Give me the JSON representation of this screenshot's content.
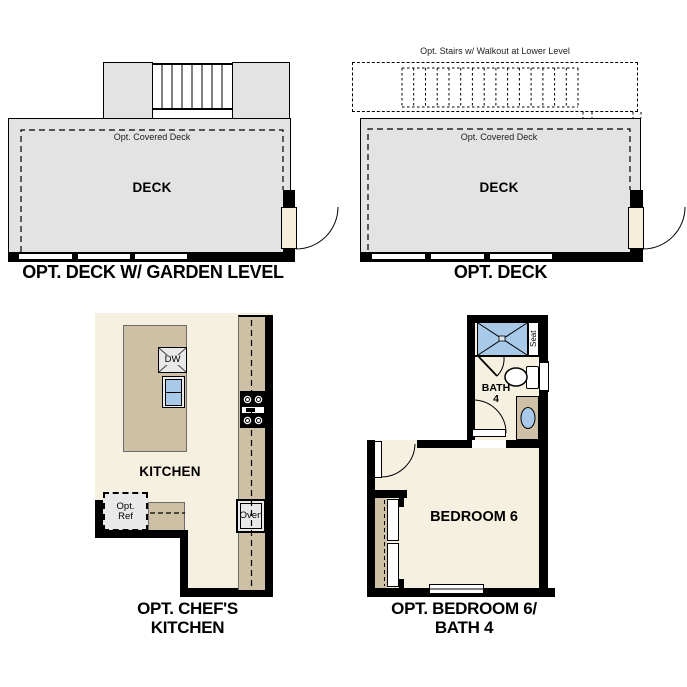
{
  "colors": {
    "wall": "#000000",
    "deck": "#e3e3e3",
    "floor": "#f6f0e0",
    "cabinet": "#cec0a5",
    "fixture": "#e9e9e9",
    "water": "#a9c9e9",
    "door": "#f4eedb"
  },
  "plans": {
    "deck_garden": {
      "caption": "OPT. DECK W/ GARDEN LEVEL",
      "deck_label": "DECK",
      "covered_deck_label": "Opt. Covered Deck"
    },
    "deck": {
      "caption": "OPT. DECK",
      "deck_label": "DECK",
      "covered_deck_label": "Opt. Covered Deck",
      "stairs_note": "Opt. Stairs w/ Walkout at Lower Level"
    },
    "chefs_kitchen": {
      "caption_line1": "OPT. CHEF'S",
      "caption_line2": "KITCHEN",
      "room_label": "KITCHEN",
      "dishwasher_label": "DW",
      "oven_label": "Oven",
      "fridge_label_line1": "Opt.",
      "fridge_label_line2": "Ref"
    },
    "bedroom6_bath4": {
      "caption_line1": "OPT. BEDROOM 6/",
      "caption_line2": "BATH 4",
      "bedroom_label": "BEDROOM 6",
      "bath_label_line1": "BATH",
      "bath_label_line2": "4",
      "seat_label": "Seat"
    }
  }
}
